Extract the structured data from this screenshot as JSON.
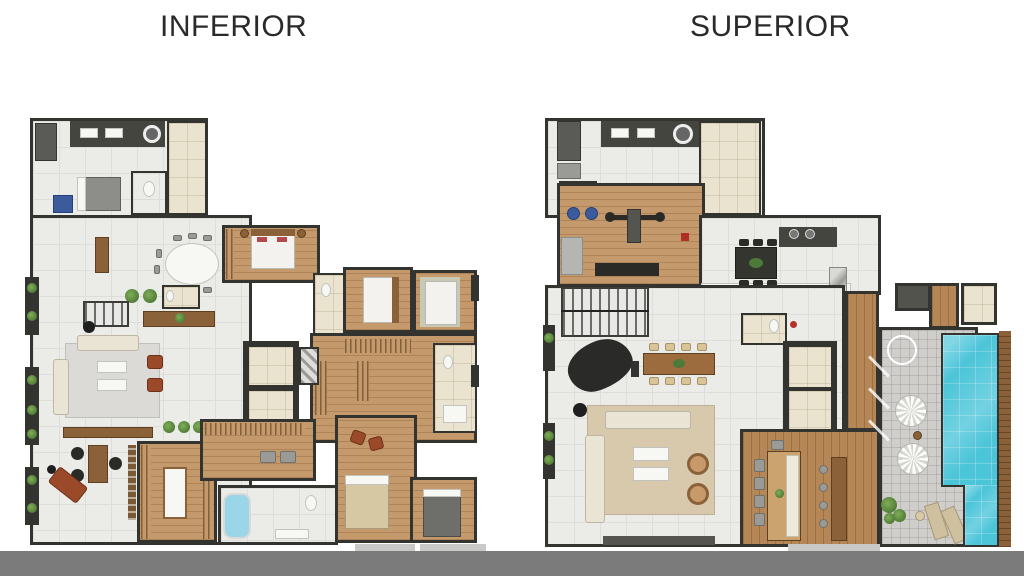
{
  "titles": {
    "inferior": "INFERIOR",
    "superior": "SUPERIOR"
  },
  "palette": {
    "title_text": "#2a2a2a",
    "wall": "#33332f",
    "tile_floor": "#ebebe8",
    "tile_line": "#dedddb",
    "wood_floor": "#c49a6c",
    "deck_wood": "#b68756",
    "beige_floor": "#eae3d0",
    "counter_dark": "#45453f",
    "appliance_blue": "#3b5b9d",
    "pool_water": "#4cc5d9",
    "paver": "#cfcecb",
    "rug_gray": "#dbdad6",
    "rug_beige": "#d8c9ad",
    "sofa_cream": "#eae4d4",
    "armchair_rust": "#9a4a28",
    "wood_furniture": "#8a6138",
    "plant_green": "#4e7a35",
    "bed_white": "#f3f2ef",
    "bed_beige": "#d6c8a2",
    "gray_bed": "#6e6e6b",
    "tub_blue": "#9ad6e8",
    "ground_band": "#7b7b7b",
    "slab_gray": "#c9c9c7"
  }
}
